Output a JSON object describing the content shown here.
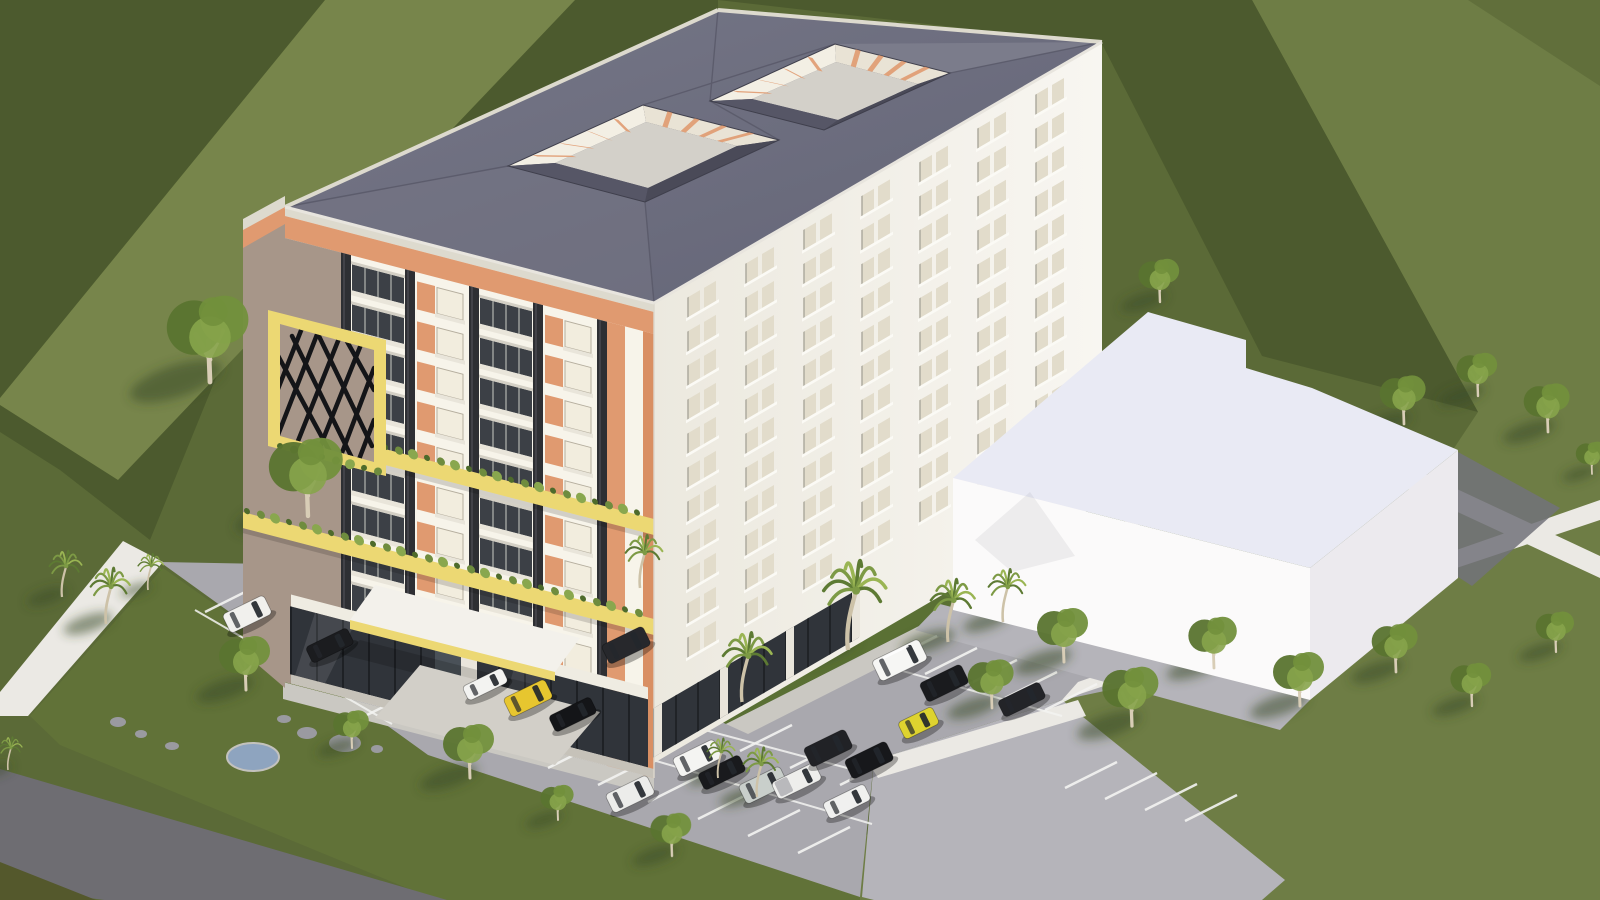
{
  "scene": {
    "palette": {
      "grassMid": "#5b6a37",
      "grassLight": "#6e7d45",
      "grassBand": "#77854b",
      "grassDark": "#4c5a2e",
      "lawn": "#617238",
      "shade": "#3c4a25",
      "road": "#6e6d72",
      "roadDark": "#54582c",
      "lot": "#a9a8ae",
      "apron": "#b5b4ba",
      "walk": "#cac8c2",
      "tile": "#d2cfc8",
      "wall": "#ebe9e4",
      "stripe": "#f4f4f2",
      "roof": "#6d6e7d",
      "roofDark": "#4e4e5c",
      "roofSlope": "#565666",
      "roofSlope2": "#4a4a58",
      "roofLight": "#7b7c8b",
      "parapet": "#dddace",
      "facade": "#f7f4ea",
      "side1": "#ece9df",
      "side2": "#f8f6f1",
      "taupe": "#a79689",
      "orange": "#e09a70",
      "orangeDeep": "#d98f63",
      "yellow": "#ecd873",
      "louver": "#2e2f33",
      "glass": "#3c4046",
      "storefront": "#30343a",
      "winLite": "#f2edde",
      "winSide": "#e2dccb",
      "sill": "#e9e5da",
      "courtFloor": "#d3d0c9",
      "courtWallA": "#f3efe4",
      "courtWallB": "#e9e3d5",
      "annexFront": "#fbfafa",
      "annexSide": "#eceaee",
      "annexRoof": "#e9eaf4",
      "alley": "#72727a",
      "hedge": "#5a7034",
      "pond": "#8ea4bf",
      "stone": "#9a9aa0",
      "trunk": "#d8cdb6",
      "palmTrunk": "#cdc2a8",
      "leaf1": "#5a742f",
      "leaf2": "#72903c",
      "leaf3": "#87a44b",
      "palmLeaf1": "#5d7a33",
      "palmLeaf2": "#7d9a45",
      "palmLeaf3": "#9ab553",
      "carGlass": "#23272c",
      "planters": [
        "#4e6b2b",
        "#6f8c3e",
        "#89a74e"
      ]
    },
    "building": {
      "front": {
        "floors": 9,
        "bays": 4,
        "bayXs": [
          66,
          130,
          194,
          258
        ],
        "bayTypes": [
          "balcony",
          "window",
          "balcony",
          "window"
        ],
        "louverXs": [
          56,
          120,
          184,
          248,
          312
        ],
        "floorTop": 40,
        "floorH": 40
      },
      "side": {
        "floors": 11,
        "cols": 7,
        "colX0": 34,
        "colDX": 58,
        "rowY0": 14,
        "rowDY": 34
      }
    },
    "courtyards": [
      {
        "outer": [
          [
            508,
            166
          ],
          [
            643,
            105
          ],
          [
            779,
            140
          ],
          [
            645,
            202
          ]
        ],
        "floor": [
          [
            555,
            163
          ],
          [
            646,
            122
          ],
          [
            737,
            146
          ],
          [
            648,
            188
          ]
        ]
      },
      {
        "outer": [
          [
            710,
            101
          ],
          [
            835,
            44
          ],
          [
            950,
            73
          ],
          [
            824,
            130
          ]
        ],
        "floor": [
          [
            752,
            99
          ],
          [
            836,
            62
          ],
          [
            918,
            84
          ],
          [
            838,
            120
          ]
        ]
      }
    ],
    "ground": {
      "pond": {
        "x": 253,
        "y": 757,
        "rx": 26,
        "ry": 14
      },
      "stones": [
        {
          "x": 118,
          "y": 722,
          "rx": 8,
          "ry": 5
        },
        {
          "x": 141,
          "y": 734,
          "rx": 6,
          "ry": 4
        },
        {
          "x": 172,
          "y": 746,
          "rx": 7,
          "ry": 4
        },
        {
          "x": 284,
          "y": 719,
          "rx": 7,
          "ry": 4
        },
        {
          "x": 307,
          "y": 733,
          "rx": 10,
          "ry": 6
        },
        {
          "x": 345,
          "y": 743,
          "rx": 16,
          "ry": 9
        },
        {
          "x": 377,
          "y": 749,
          "rx": 6,
          "ry": 4
        }
      ],
      "stripeGroups": [
        {
          "dx": 52,
          "dy": -26,
          "pts": [
            [
              205,
              612
            ],
            [
              245,
              638
            ],
            [
              285,
              664
            ],
            [
              325,
              690
            ],
            [
              365,
              716
            ]
          ]
        },
        {
          "dx": 52,
          "dy": -26,
          "pts": [
            [
              590,
              700
            ],
            [
              640,
              717
            ],
            [
              690,
              734
            ],
            [
              740,
              751
            ],
            [
              790,
              768
            ],
            [
              840,
              785
            ]
          ]
        },
        {
          "dx": -52,
          "dy": 26,
          "pts": [
            [
              600,
              742
            ],
            [
              650,
              759
            ],
            [
              700,
              776
            ],
            [
              750,
              793
            ],
            [
              800,
              810
            ],
            [
              850,
              827
            ]
          ]
        },
        {
          "dx": 52,
          "dy": -26,
          "pts": [
            [
              885,
              662
            ],
            [
              925,
              674
            ],
            [
              965,
              686
            ],
            [
              1005,
              698
            ],
            [
              1045,
              710
            ]
          ]
        },
        {
          "dx": 52,
          "dy": -26,
          "pts": [
            [
              1065,
              788
            ],
            [
              1105,
              799
            ],
            [
              1145,
              810
            ],
            [
              1185,
              821
            ]
          ]
        }
      ],
      "lanes": [
        [
          195,
          610,
          392,
          724
        ],
        [
          585,
          698,
          862,
          772
        ],
        [
          598,
          744,
          872,
          824
        ],
        [
          878,
          664,
          1062,
          716
        ]
      ]
    },
    "cars": [
      {
        "x": 250,
        "y": 620,
        "c": "#f1f0ed",
        "t": "suv"
      },
      {
        "x": 332,
        "y": 650,
        "c": "#1b1c1f",
        "t": "sedan"
      },
      {
        "x": 487,
        "y": 688,
        "c": "#f3f3f1",
        "t": "sport"
      },
      {
        "x": 531,
        "y": 704,
        "c": "#e7c62f",
        "t": "suv"
      },
      {
        "x": 575,
        "y": 719,
        "c": "#141518",
        "t": "sedan"
      },
      {
        "x": 629,
        "y": 651,
        "c": "#27282c",
        "t": "suv"
      },
      {
        "x": 700,
        "y": 764,
        "c": "#f4f4f2",
        "t": "suv"
      },
      {
        "x": 724,
        "y": 777,
        "c": "#191a1d",
        "t": "sedan"
      },
      {
        "x": 766,
        "y": 791,
        "c": "#c9cfcb",
        "t": "suv"
      },
      {
        "x": 799,
        "y": 786,
        "c": "#eeeeec",
        "t": "pickup"
      },
      {
        "x": 831,
        "y": 754,
        "c": "#212226",
        "t": "suv"
      },
      {
        "x": 872,
        "y": 766,
        "c": "#17181b",
        "t": "suv"
      },
      {
        "x": 849,
        "y": 806,
        "c": "#f0f0ef",
        "t": "sedan"
      },
      {
        "x": 633,
        "y": 800,
        "c": "#ececea",
        "t": "suv"
      },
      {
        "x": 903,
        "y": 667,
        "c": "#f6f6f4",
        "t": "van"
      },
      {
        "x": 947,
        "y": 689,
        "c": "#1a1b1e",
        "t": "suv"
      },
      {
        "x": 921,
        "y": 728,
        "c": "#ded32f",
        "t": "hatch"
      },
      {
        "x": 1024,
        "y": 704,
        "c": "#232428",
        "t": "sedan"
      }
    ],
    "palms": [
      {
        "x": 640,
        "y": 588,
        "s": 0.8
      },
      {
        "x": 742,
        "y": 702,
        "s": 1.05
      },
      {
        "x": 848,
        "y": 650,
        "s": 1.35
      },
      {
        "x": 948,
        "y": 642,
        "s": 0.95
      },
      {
        "x": 1003,
        "y": 622,
        "s": 0.8
      },
      {
        "x": 62,
        "y": 597,
        "s": 0.7
      },
      {
        "x": 106,
        "y": 624,
        "s": 0.85
      },
      {
        "x": 148,
        "y": 590,
        "s": 0.55
      },
      {
        "x": 718,
        "y": 778,
        "s": 0.6
      },
      {
        "x": 757,
        "y": 797,
        "s": 0.75
      },
      {
        "x": 8,
        "y": 770,
        "s": 0.5
      }
    ],
    "trees": [
      {
        "x": 210,
        "y": 382,
        "s": 1.6
      },
      {
        "x": 308,
        "y": 516,
        "s": 1.45
      },
      {
        "x": 246,
        "y": 690,
        "s": 1.0
      },
      {
        "x": 352,
        "y": 748,
        "s": 0.7
      },
      {
        "x": 470,
        "y": 778,
        "s": 1.0
      },
      {
        "x": 558,
        "y": 820,
        "s": 0.65
      },
      {
        "x": 672,
        "y": 856,
        "s": 0.8
      },
      {
        "x": 992,
        "y": 708,
        "s": 0.9
      },
      {
        "x": 1064,
        "y": 662,
        "s": 1.0
      },
      {
        "x": 1132,
        "y": 726,
        "s": 1.1
      },
      {
        "x": 1214,
        "y": 668,
        "s": 0.95
      },
      {
        "x": 1300,
        "y": 706,
        "s": 1.0
      },
      {
        "x": 1396,
        "y": 672,
        "s": 0.9
      },
      {
        "x": 1472,
        "y": 706,
        "s": 0.8
      },
      {
        "x": 1556,
        "y": 652,
        "s": 0.75
      },
      {
        "x": 1160,
        "y": 302,
        "s": 0.8
      },
      {
        "x": 1404,
        "y": 424,
        "s": 0.9
      },
      {
        "x": 1478,
        "y": 396,
        "s": 0.8
      },
      {
        "x": 1548,
        "y": 432,
        "s": 0.9
      },
      {
        "x": 1592,
        "y": 474,
        "s": 0.6
      }
    ]
  }
}
